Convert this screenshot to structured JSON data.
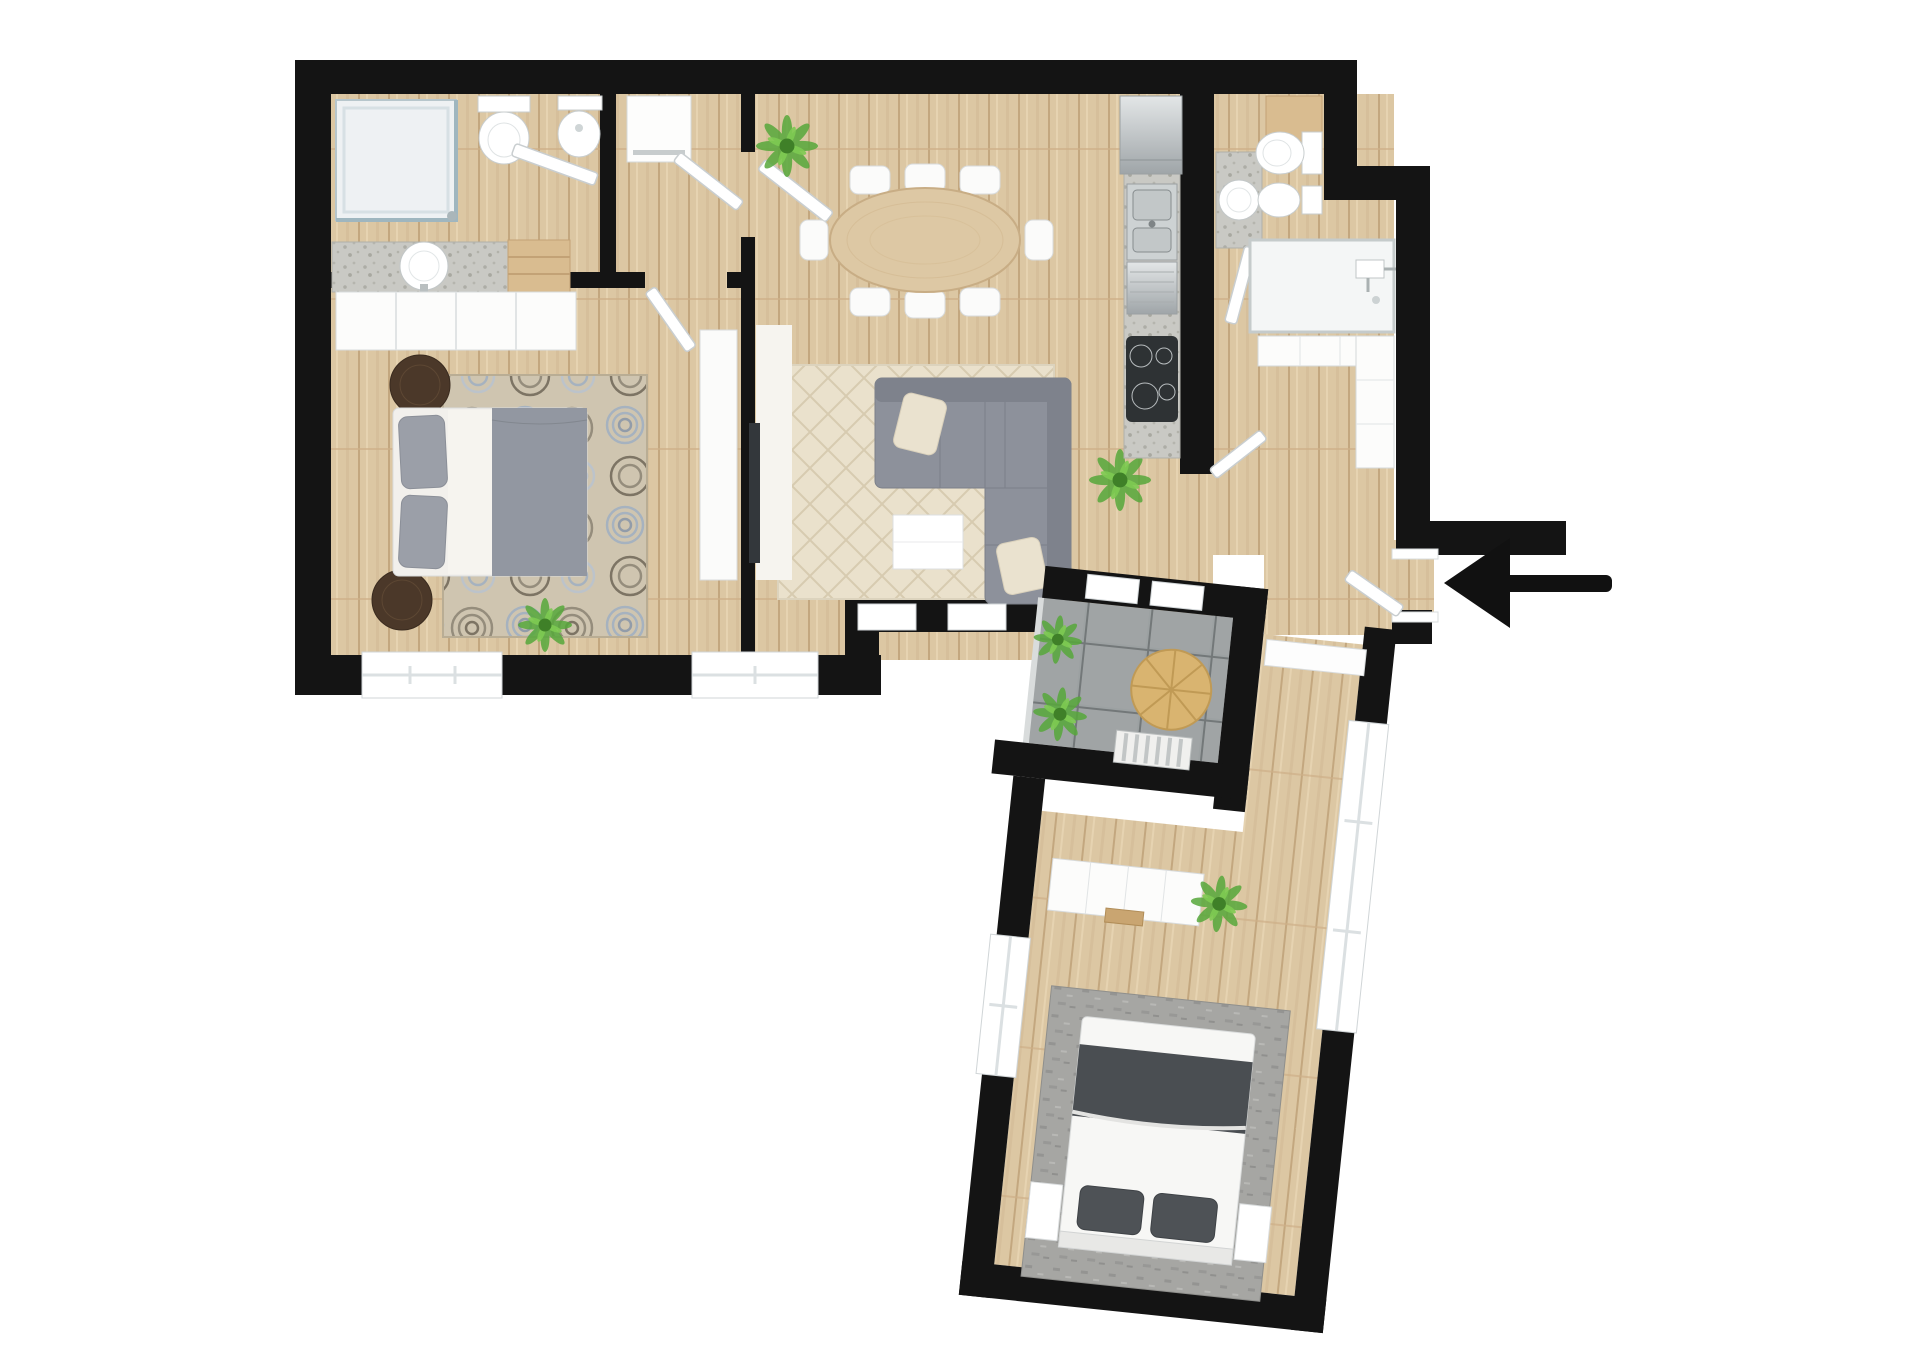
{
  "scene": {
    "type": "floor-plan",
    "style": "top-down-3d-render",
    "background": "#ffffff"
  },
  "palette": {
    "wall": "#141414",
    "floor_wood": "#dcc7a3",
    "floor_tile": "#9ca1a2",
    "floor_shower": "#f4f6f6",
    "counter_terrazzo": "#c9c9c4",
    "fixture_white": "#ffffff",
    "furniture_white": "#fafafa",
    "sofa_gray": "#8d919b",
    "bed_duvet_gray": "#9297a1",
    "bed2_dark": "#4a4e52",
    "rug_cream": "#eae1cc",
    "rug_floral_base": "#cfc5b0",
    "rug_gray": "#a6a6a3",
    "stool_brown": "#4b3829",
    "plant_green": "#57a83b",
    "table_wood": "#ddc8a4",
    "terrace_table_wood": "#d9b470",
    "stainless": "#c6cbcd",
    "tv_dark": "#33373b",
    "arrow_black": "#111111",
    "glass": "#9fb6bf"
  },
  "rooms": [
    {
      "id": "bathroom-1",
      "area": "top-left",
      "fixtures": [
        "corner-shower",
        "toilet",
        "bidet",
        "vanity-sink",
        "wood-cabinet"
      ]
    },
    {
      "id": "hallway",
      "area": "top-center",
      "fixtures": [
        "white-cabinet"
      ]
    },
    {
      "id": "master-bedroom",
      "area": "left",
      "fixtures": [
        "double-bed",
        "wardrobe",
        "floral-rug",
        "round-stool",
        "round-stool",
        "tv-cabinet",
        "plant"
      ]
    },
    {
      "id": "living-dining-room",
      "area": "center",
      "fixtures": [
        "oval-dining-table",
        "eight-chairs",
        "corner-sofa",
        "coffee-table",
        "cream-rug",
        "sideboard",
        "wall-tv",
        "plants"
      ]
    },
    {
      "id": "kitchen",
      "area": "center-right-strip",
      "fixtures": [
        "fridge",
        "double-sink",
        "dishwasher",
        "induction-hob",
        "counter",
        "plant"
      ]
    },
    {
      "id": "bathroom-2",
      "area": "top-right",
      "fixtures": [
        "vanity-sink",
        "toilet",
        "bidet",
        "wood-cabinet"
      ]
    },
    {
      "id": "shower-room",
      "area": "top-right",
      "fixtures": [
        "walk-in-shower"
      ]
    },
    {
      "id": "entry-hall",
      "area": "right",
      "fixtures": [
        "l-shaped-closet",
        "front-door"
      ]
    },
    {
      "id": "terrace",
      "area": "center-bottom",
      "fixtures": [
        "round-wood-table",
        "slatted-bench",
        "plants"
      ]
    },
    {
      "id": "bedroom-2",
      "area": "bottom-right-wing",
      "fixtures": [
        "double-bed",
        "nightstand",
        "nightstand",
        "wardrobe",
        "gray-rug",
        "plant"
      ]
    }
  ],
  "entrance": {
    "icon": "entrance-arrow-icon",
    "direction": "left",
    "location": "right-side-wall"
  }
}
